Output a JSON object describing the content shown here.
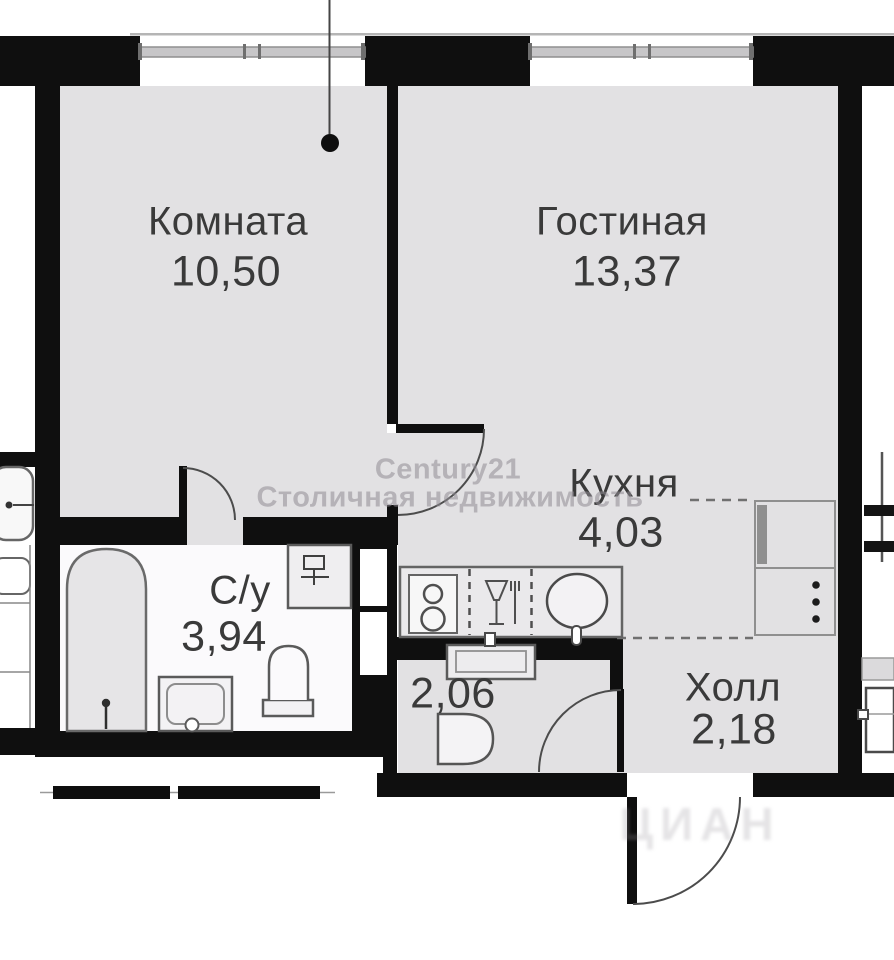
{
  "rooms": {
    "komnata": {
      "label": "Комната",
      "area": "10,50"
    },
    "gostinaya": {
      "label": "Гостиная",
      "area": "13,37"
    },
    "kuhnya": {
      "label": "Кухня",
      "area": "4,03"
    },
    "su": {
      "label": "С/у",
      "area": "3,94"
    },
    "room_2_06": {
      "area": "2,06"
    },
    "holl": {
      "label": "Холл",
      "area": "2,18"
    }
  },
  "watermarks": {
    "agency_line1": "Century21",
    "agency_line2": "Столичная недвижимость",
    "portal": "ЦИАН"
  },
  "colors": {
    "wall": "#0f0f0f",
    "room_fill": "#e2e1e3",
    "wet_room_fill": "#fbfafc",
    "label": "#3a3a3a",
    "watermark": "#8f8d93"
  }
}
